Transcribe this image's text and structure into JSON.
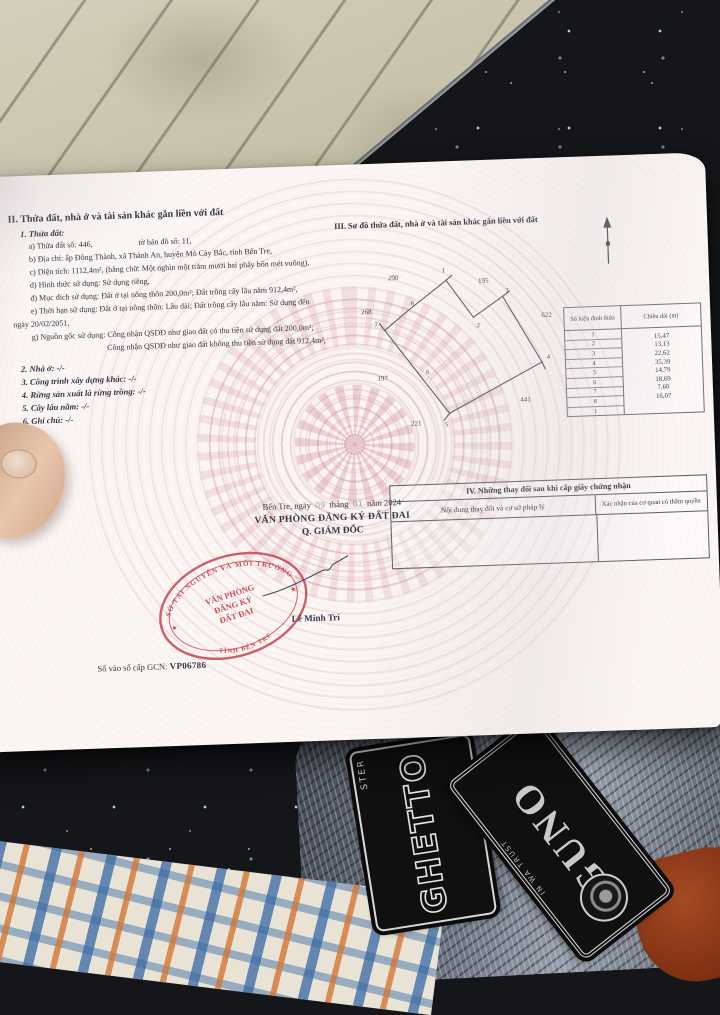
{
  "scene": {
    "patch_ghetto_main": "GHETTO",
    "patch_ghetto_sub": "STER",
    "patch_dollar_main": "GUNO",
    "patch_dollar_sub": "IN WA TRUST"
  },
  "doc": {
    "section2": {
      "heading": "II. Thửa đất, nhà ở và tài sản khác gắn liền với đất",
      "item1": "1. Thửa đất:",
      "a_left": "a) Thửa đất số: 446,",
      "a_right": "tờ bản đồ số: 11,",
      "b": "b) Địa chỉ: ấp Đông Thành, xã Thành An, huyện Mỏ Cày Bắc, tỉnh Bến Tre,",
      "c": "c) Diện tích: 1112,4m², (bằng chữ: Một nghìn một trăm mười hai phẩy bốn mét vuông),",
      "d": "d) Hình thức sử dụng: Sử dụng riêng,",
      "dd": "đ) Mục đích sử dụng: Đất ở tại nông thôn 200,0m²; Đất trồng cây lâu năm 912,4m²,",
      "e1": "e) Thời hạn sử dụng: Đất ở tại nông thôn: Lâu dài; Đất trồng cây lâu năm: Sử dụng đến",
      "e2": "ngày 20/02/2051,",
      "g1": "g) Nguồn gốc sử dụng: Công nhận QSDĐ như giao đất có thu tiền sử dụng đất 200,0m²;",
      "g2": "Công nhận QSDĐ như giao đất không thu tiền sử dụng đất 912,4m²,",
      "item2": "2. Nhà ở: -/-",
      "item3": "3. Công trình xây dựng khác: -/-",
      "item4": "4. Rừng sản xuất là rừng trồng: -/-",
      "item5": "5. Cây lâu năm: -/-",
      "item6": "6. Ghi chú: -/-"
    },
    "section3": {
      "heading": "III. Sơ đồ thửa đất, nhà ở và tài sản khác gắn liền với đất",
      "vertices": [
        "1",
        "2",
        "3",
        "4",
        "5",
        "6",
        "7",
        "8"
      ],
      "neighbors": {
        "top_left": "290",
        "top_right": "195",
        "left": "268",
        "right": "622",
        "mid_left": "197",
        "bottom_right": "441",
        "bottom_left": "221"
      },
      "table": {
        "header_col1": "Số hiệu đỉnh thửa",
        "header_col2": "Chiều dài (m)",
        "vertex_rows": [
          "1",
          "2",
          "3",
          "4",
          "5",
          "6",
          "7",
          "8",
          "1"
        ],
        "lengths": [
          "15,47",
          "13,13",
          "22,62",
          "35,39",
          "14,79",
          "18,69",
          "7,60",
          "16,07"
        ]
      }
    },
    "section4": {
      "heading": "IV. Những thay đổi sau khi cấp giấy chứng nhận",
      "col1": "Nội dung thay đổi và cơ sở pháp lý",
      "col2": "Xác nhận của cơ quan có thẩm quyền"
    },
    "signing": {
      "place_date": "Bến Tre, ngày",
      "day": "09",
      "thang": "tháng",
      "month": "01",
      "nam": "năm 2024",
      "office": "VĂN PHÒNG ĐĂNG KÝ ĐẤT ĐAI",
      "role": "Q. GIÁM ĐỐC",
      "stamp_ring_top": "SỞ TÀI NGUYÊN VÀ MÔI TRƯỜNG",
      "stamp_ring_bottom": "TỈNH BẾN TRE",
      "stamp_line1": "VĂN PHÒNG",
      "stamp_line2": "ĐĂNG KÝ",
      "stamp_line3": "ĐẤT ĐAI",
      "signer": "Lê Minh Trí"
    },
    "footer": {
      "label": "Số vào sổ cấp GCN:",
      "serial": "VP06786"
    }
  },
  "colors": {
    "stamp_red": "#c2414b",
    "ink": "#343542",
    "paper": "#fbf6f4"
  }
}
